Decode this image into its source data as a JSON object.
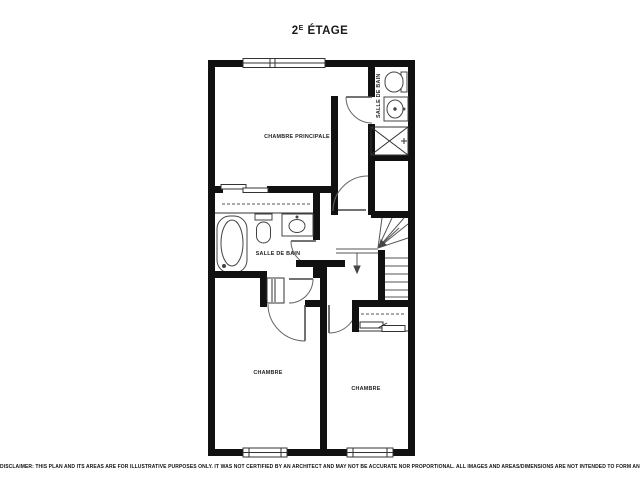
{
  "title": {
    "base": "2",
    "sup": "E",
    "rest": "ÉTAGE"
  },
  "rooms": {
    "master_bedroom": "CHAMBRE PRINCIPALE",
    "bathroom_top": "SALLE DE BAIN",
    "bathroom_middle": "SALLE DE BAIN",
    "bedroom_left": "CHAMBRE",
    "bedroom_right": "CHAMBRE"
  },
  "disclaimer": "DISCLAIMER: THIS PLAN AND ITS AREAS ARE FOR ILLUSTRATIVE PURPOSES ONLY. IT WAS NOT CERTIFIED BY AN ARCHITECT AND MAY NOT BE ACCURATE NOR PROPORTIONAL. ALL IMAGES AND AREAS/DIMENSIONS ARE NOT INTENDED TO FORM ANY CONTRACT OR WARRANTY.",
  "colors": {
    "background": "#ffffff",
    "walls": "#111111",
    "thin_lines": "#444444",
    "text": "#1a1a1a"
  }
}
